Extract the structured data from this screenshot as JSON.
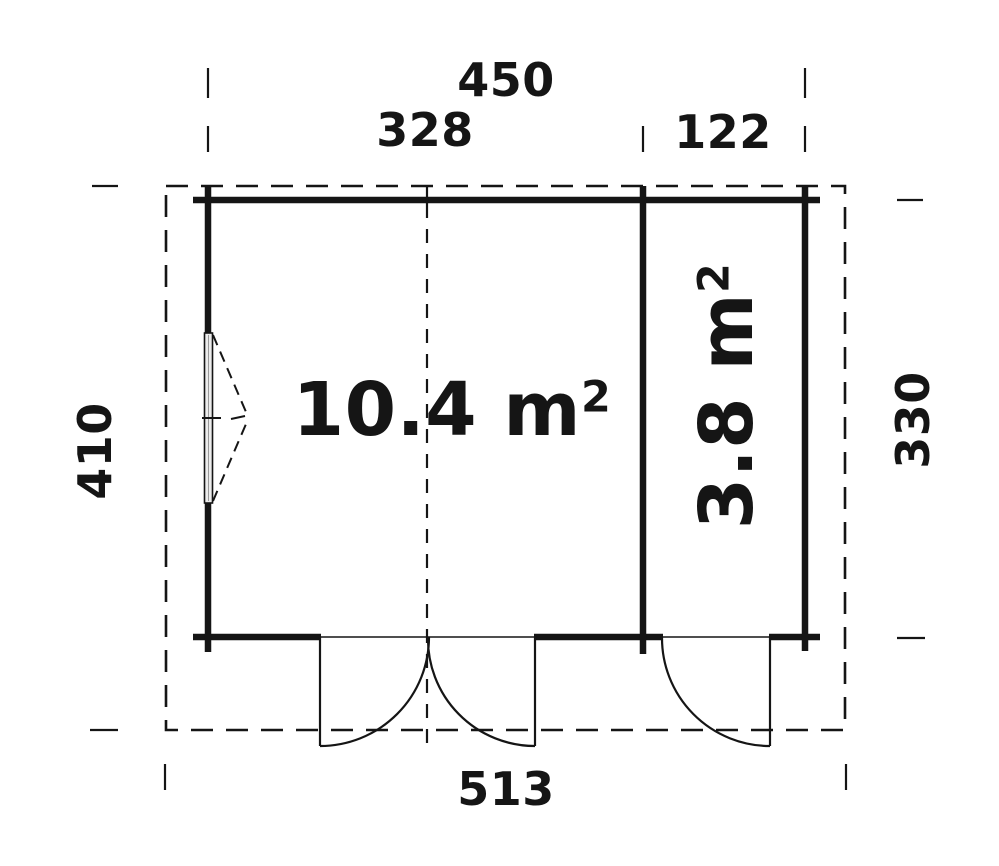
{
  "drawing": {
    "title": "shed-floor-plan",
    "background_color": "#ffffff",
    "ink_color": "#151515",
    "window_fill_color": "#ececec"
  },
  "dimension_labels": {
    "top_total_width": "450",
    "top_room1_width": "328",
    "top_room2_width": "122",
    "left_overall_depth": "410",
    "right_wall_depth": "330",
    "bottom_overall_width": "513"
  },
  "room_labels": {
    "room1": {
      "area": "10.4 m",
      "exponent": "2"
    },
    "room2": {
      "area": "3.8 m",
      "exponent": "2"
    }
  }
}
